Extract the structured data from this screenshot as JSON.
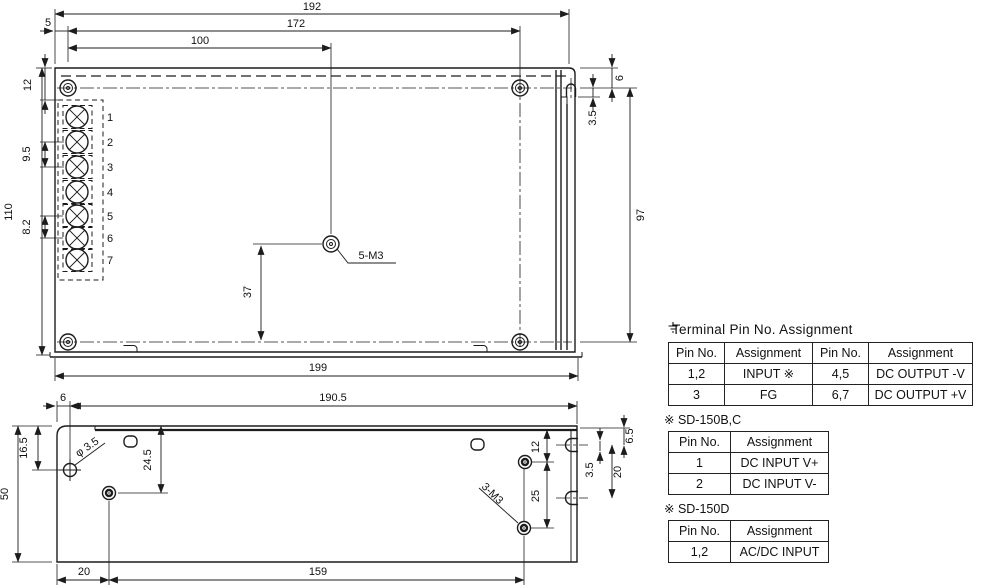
{
  "top_view": {
    "dims": {
      "overall_width": "192",
      "hole_span_w": "172",
      "center_hole_x": "100",
      "edge_offset": "5",
      "overall_height": "110",
      "top_offset": "12",
      "pitch_a": "9.5",
      "pitch_b": "8.2",
      "center_drop": "37",
      "base_length": "199",
      "side_span": "97",
      "slot_offset": "6",
      "slot_width": "3.5",
      "screw_note": "5-M3"
    },
    "terminals": [
      "1",
      "2",
      "3",
      "4",
      "5",
      "6",
      "7"
    ]
  },
  "side_view": {
    "dims": {
      "edge_offset": "6",
      "hole_span": "190.5",
      "hole_top": "16.5",
      "height": "50",
      "hole_dia": "φ 3.5",
      "screw_top": "24.5",
      "foot_offset": "20",
      "screw_span": "159",
      "screw_offset_top": "12",
      "screw_pitch": "25",
      "notch_width": "3.5",
      "notch_pitch": "20",
      "notch_offset": "6.5",
      "screw_note": "3-M3"
    }
  },
  "tables": {
    "main": {
      "title": "Terminal Pin No. Assignment",
      "headers": [
        "Pin No.",
        "Assignment",
        "Pin No.",
        "Assignment"
      ],
      "rows": [
        [
          "1,2",
          "INPUT ※",
          "4,5",
          "DC OUTPUT -V"
        ],
        [
          "3",
          "FG",
          "6,7",
          "DC OUTPUT +V"
        ]
      ]
    },
    "model_bc": {
      "label": "※ SD-150B,C",
      "headers": [
        "Pin No.",
        "Assignment"
      ],
      "rows": [
        [
          "1",
          "DC INPUT V+"
        ],
        [
          "2",
          "DC INPUT V-"
        ]
      ]
    },
    "model_d": {
      "label": "※ SD-150D",
      "headers": [
        "Pin No.",
        "Assignment"
      ],
      "rows": [
        [
          "1,2",
          "AC/DC INPUT"
        ]
      ]
    }
  }
}
